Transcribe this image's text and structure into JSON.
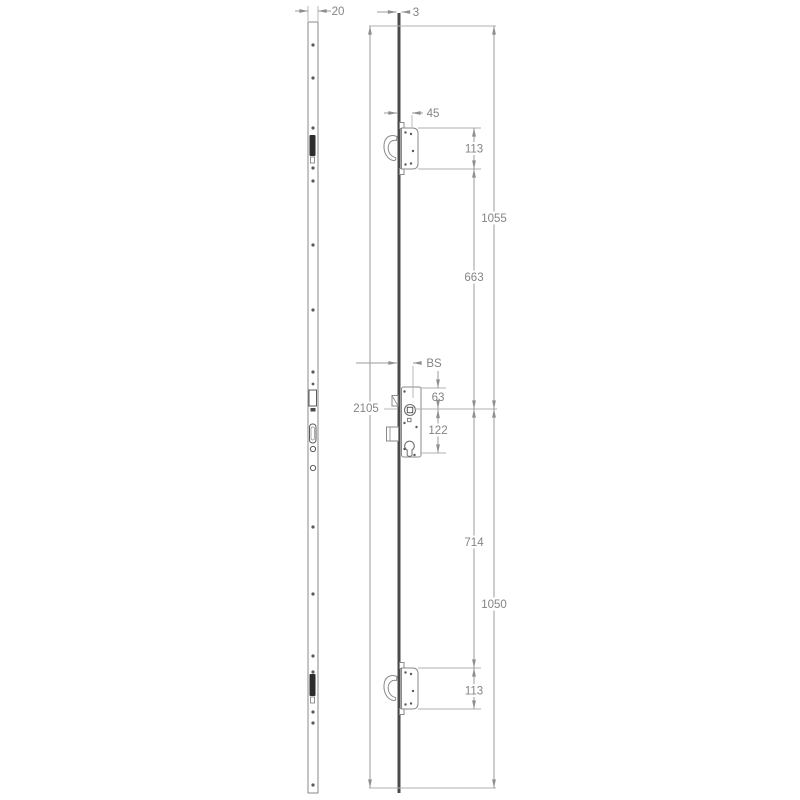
{
  "drawing": {
    "title": "multipoint-lock-technical-drawing",
    "colors": {
      "background": "#ffffff",
      "dimension_line": "#9b9b9b",
      "part_outline": "#8a8a8a",
      "channel_dark": "#4a4a4a",
      "slot_fill": "#2d2d2d",
      "label_text": "#848484"
    },
    "dimensions": {
      "faceplate_width": "20",
      "channel_thickness": "3",
      "top_backset": "45",
      "top_case_height": "113",
      "top_end_to_centre": "1055",
      "top_case_to_centre": "663",
      "backset": "BS",
      "total_length": "2105",
      "case_top_to_spindle": "63",
      "spindle_to_cylinder": "122",
      "centre_to_bottom_case": "714",
      "centre_to_bottom_end": "1050",
      "bottom_case_height": "113"
    }
  }
}
